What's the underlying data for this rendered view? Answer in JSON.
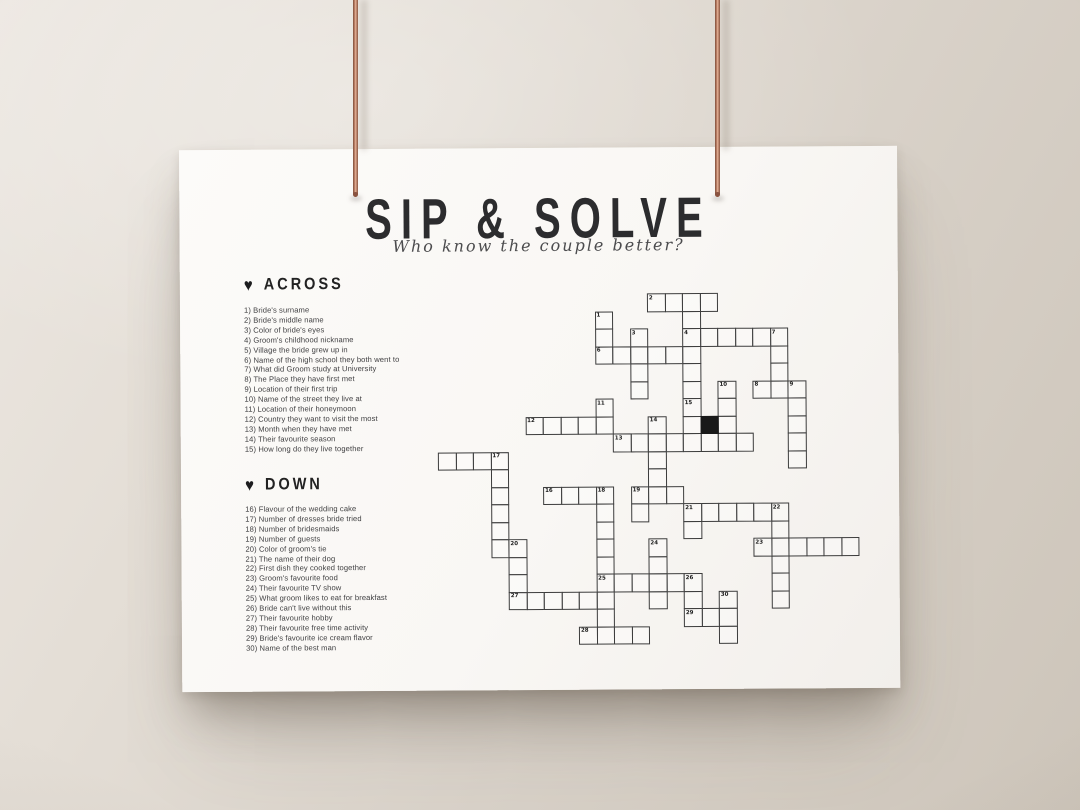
{
  "poster": {
    "title": "SIP & SOLVE",
    "subtitle": "Who know the couple better?",
    "heart_glyph": "♥",
    "across": {
      "heading": "ACROSS",
      "items": [
        "1) Bride's surname",
        "2) Bride's middle name",
        "3) Color of bride's eyes",
        "4) Groom's childhood nickname",
        "5) Village the bride grew up in",
        "6) Name of the high school they both went to",
        "7) What did Groom study at University",
        "8) The Place they have first met",
        "9) Location of their first trip",
        "10) Name of the street they live at",
        "11) Location of their honeymoon",
        "12) Country they want to visit the most",
        "13) Month when they have met",
        "14) Their favourite season",
        "15) How long do they live together"
      ]
    },
    "down": {
      "heading": "DOWN",
      "items": [
        "16) Flavour of the wedding cake",
        "17) Number of dresses bride tried",
        "18) Number of bridesmaids",
        "19) Number of guests",
        "20) Color of groom's tie",
        "21) The name of their dog",
        "22) First dish they cooked together",
        "23) Groom's favourite food",
        "24) Their favourite TV show",
        "25) What groom likes to eat for breakfast",
        "26) Bride can't live without this",
        "27) Their favourite hobby",
        "28) Their favourite free time activity",
        "29) Bride's favourite ice cream flavor",
        "30) Name of the best man"
      ]
    }
  },
  "crossword": {
    "cell_size": 17.5,
    "cols": 24,
    "rows": 21,
    "line_color": "#3c3c3c",
    "runs": [
      {
        "dir": "h",
        "col": 12,
        "row": 0,
        "len": 4
      },
      {
        "dir": "h",
        "col": 14,
        "row": 2,
        "len": 6
      },
      {
        "dir": "h",
        "col": 9,
        "row": 3,
        "len": 6
      },
      {
        "dir": "h",
        "col": 18,
        "row": 5,
        "len": 3
      },
      {
        "dir": "h",
        "col": 5,
        "row": 7,
        "len": 5
      },
      {
        "dir": "h",
        "col": 10,
        "row": 8,
        "len": 8
      },
      {
        "dir": "h",
        "col": 0,
        "row": 9,
        "len": 4
      },
      {
        "dir": "h",
        "col": 6,
        "row": 11,
        "len": 4
      },
      {
        "dir": "h",
        "col": 11,
        "row": 11,
        "len": 3
      },
      {
        "dir": "h",
        "col": 14,
        "row": 12,
        "len": 6
      },
      {
        "dir": "h",
        "col": 18,
        "row": 14,
        "len": 6
      },
      {
        "dir": "h",
        "col": 9,
        "row": 16,
        "len": 6
      },
      {
        "dir": "h",
        "col": 4,
        "row": 17,
        "len": 5
      },
      {
        "dir": "h",
        "col": 14,
        "row": 18,
        "len": 3
      },
      {
        "dir": "h",
        "col": 8,
        "row": 19,
        "len": 4
      },
      {
        "dir": "v",
        "col": 14,
        "row": 0,
        "len": 9
      },
      {
        "dir": "v",
        "col": 9,
        "row": 1,
        "len": 3
      },
      {
        "dir": "v",
        "col": 11,
        "row": 2,
        "len": 4
      },
      {
        "dir": "v",
        "col": 19,
        "row": 2,
        "len": 4
      },
      {
        "dir": "v",
        "col": 16,
        "row": 5,
        "len": 4
      },
      {
        "dir": "v",
        "col": 20,
        "row": 5,
        "len": 5
      },
      {
        "dir": "v",
        "col": 9,
        "row": 6,
        "len": 2
      },
      {
        "dir": "v",
        "col": 12,
        "row": 7,
        "len": 5
      },
      {
        "dir": "v",
        "col": 3,
        "row": 9,
        "len": 6
      },
      {
        "dir": "v",
        "col": 9,
        "row": 11,
        "len": 9
      },
      {
        "dir": "v",
        "col": 11,
        "row": 11,
        "len": 2
      },
      {
        "dir": "v",
        "col": 19,
        "row": 12,
        "len": 6
      },
      {
        "dir": "v",
        "col": 14,
        "row": 12,
        "len": 2
      },
      {
        "dir": "v",
        "col": 4,
        "row": 14,
        "len": 4
      },
      {
        "dir": "v",
        "col": 12,
        "row": 14,
        "len": 4
      },
      {
        "dir": "v",
        "col": 14,
        "row": 16,
        "len": 3
      },
      {
        "dir": "v",
        "col": 16,
        "row": 17,
        "len": 3
      }
    ],
    "numbers": [
      {
        "n": 1,
        "col": 9,
        "row": 1
      },
      {
        "n": 2,
        "col": 12,
        "row": 0
      },
      {
        "n": 3,
        "col": 11,
        "row": 2
      },
      {
        "n": 4,
        "col": 14,
        "row": 2
      },
      {
        "n": 6,
        "col": 9,
        "row": 3
      },
      {
        "n": 7,
        "col": 19,
        "row": 2
      },
      {
        "n": 8,
        "col": 18,
        "row": 5
      },
      {
        "n": 9,
        "col": 20,
        "row": 5
      },
      {
        "n": 10,
        "col": 16,
        "row": 5
      },
      {
        "n": 11,
        "col": 9,
        "row": 6
      },
      {
        "n": 12,
        "col": 5,
        "row": 7
      },
      {
        "n": 13,
        "col": 10,
        "row": 8
      },
      {
        "n": 14,
        "col": 12,
        "row": 7
      },
      {
        "n": 15,
        "col": 14,
        "row": 6
      },
      {
        "n": 16,
        "col": 6,
        "row": 11
      },
      {
        "n": 17,
        "col": 3,
        "row": 9
      },
      {
        "n": 18,
        "col": 9,
        "row": 11
      },
      {
        "n": 19,
        "col": 11,
        "row": 11
      },
      {
        "n": 20,
        "col": 4,
        "row": 14
      },
      {
        "n": 21,
        "col": 14,
        "row": 12
      },
      {
        "n": 22,
        "col": 19,
        "row": 12
      },
      {
        "n": 23,
        "col": 18,
        "row": 14
      },
      {
        "n": 24,
        "col": 12,
        "row": 14
      },
      {
        "n": 25,
        "col": 9,
        "row": 16
      },
      {
        "n": 26,
        "col": 14,
        "row": 16
      },
      {
        "n": 27,
        "col": 4,
        "row": 17
      },
      {
        "n": 28,
        "col": 8,
        "row": 19
      },
      {
        "n": 29,
        "col": 14,
        "row": 18
      },
      {
        "n": 30,
        "col": 16,
        "row": 17
      }
    ],
    "black_cells": [
      {
        "col": 15,
        "row": 7
      }
    ]
  },
  "colors": {
    "wall": "#d9d2c9",
    "paper": "#f9f7f4",
    "ink": "#2c2c2e",
    "copper": "#b5795f"
  }
}
